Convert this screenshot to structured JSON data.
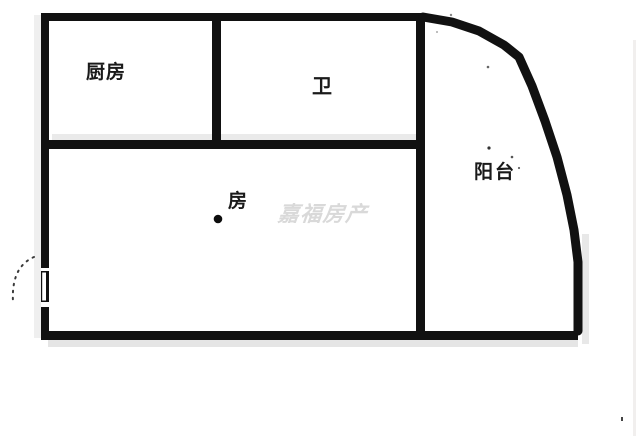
{
  "canvas": {
    "width": 640,
    "height": 436
  },
  "colors": {
    "background": "#ffffff",
    "wall": "#111111",
    "label_text": "#1a1a1a",
    "watermark_text": "#d9d9d9",
    "shadow": "#e7e7e7"
  },
  "rooms": {
    "kitchen": {
      "label": "厨房"
    },
    "bathroom": {
      "label": "卫"
    },
    "bedroom": {
      "label": "房"
    },
    "balcony": {
      "label": "阳台"
    }
  },
  "watermark": {
    "text": "嘉福房产"
  }
}
